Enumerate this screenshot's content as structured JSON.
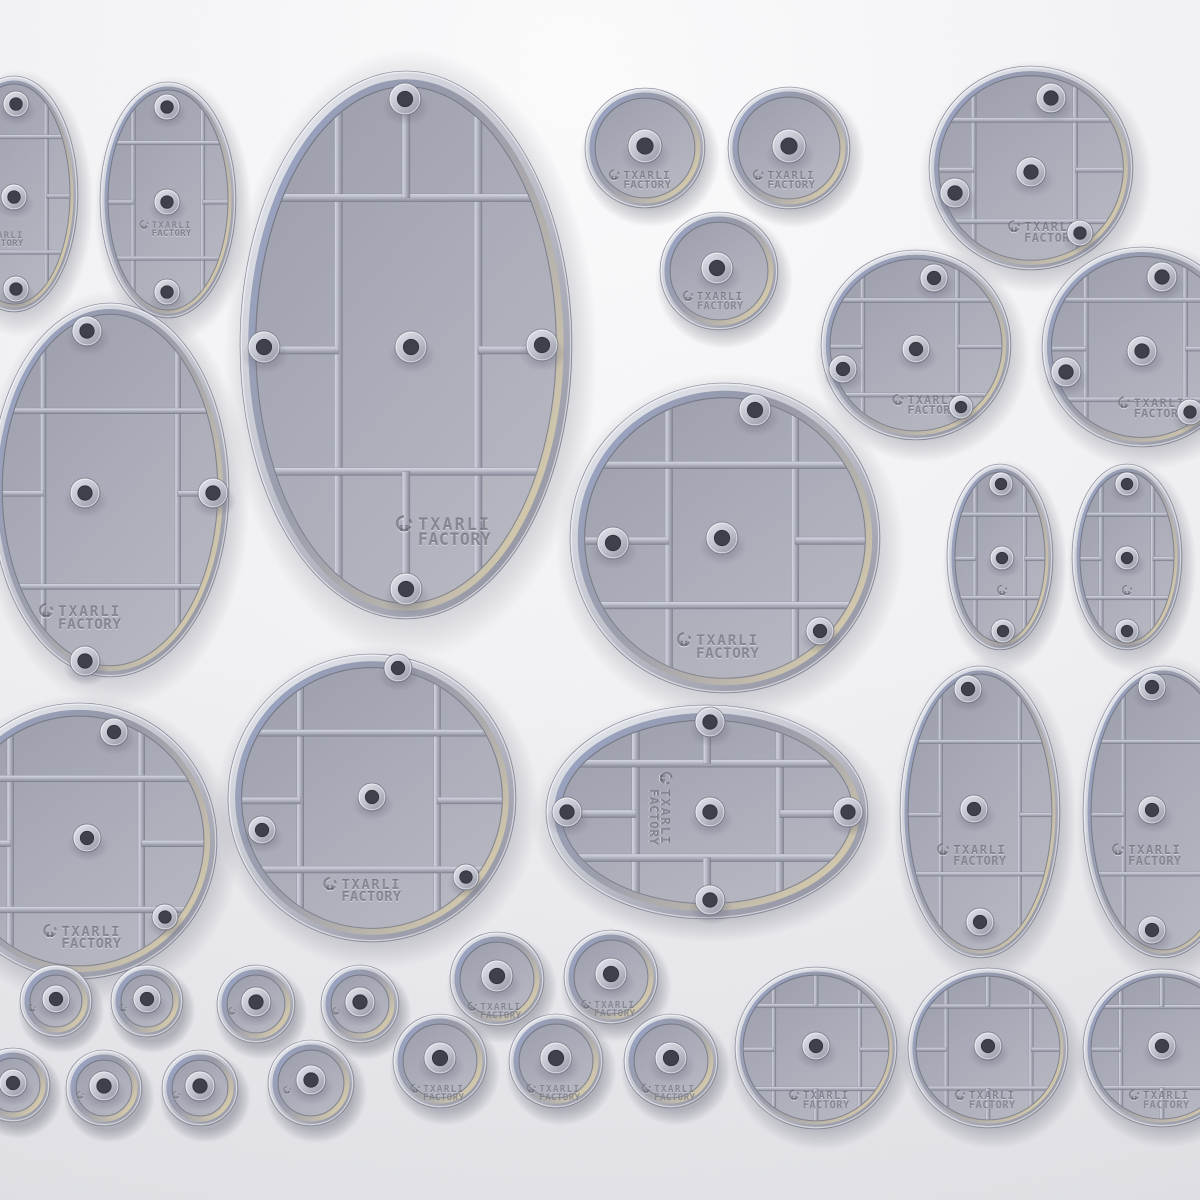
{
  "image": {
    "kind": "3d-product-render",
    "subject": "hollow miniature bases sprue-less set, top-down render"
  },
  "brand": {
    "logo_line1": "TXARLI",
    "logo_line2": "FACTORY",
    "logo_icon": "helmet-icon"
  },
  "palette": {
    "background_top": "#fbfbfc",
    "background_edge": "#e7e7eb",
    "rim_light": "#eceef4",
    "rim_dark": "#8f919f",
    "recess_dark": "#868898",
    "recess_tan": "#c8c1ad",
    "floor_gray": "#aeb0bc",
    "rib_highlight": "#d9dce8",
    "rib_shadow": "#878998",
    "accent_blue": "#9fb0dc",
    "accent_tan": "#d6cbac",
    "peg_hole": "#3e3f49",
    "engraving": "#595b68"
  },
  "bases": [
    {
      "id": "oval-cut-top-left",
      "shape": "ellipse",
      "style": "ribbed",
      "cx": 14,
      "cy": 194,
      "rx": 64,
      "ry": 118,
      "vx": [
        -0.58,
        0.58
      ],
      "hy": [
        -0.52,
        0.53
      ],
      "stubs": [
        "l",
        "r"
      ],
      "pegs": [
        [
          16,
          104,
          13
        ],
        [
          14,
          197,
          13
        ],
        [
          16,
          289,
          13
        ]
      ],
      "logo": {
        "x": 0,
        "y": 238,
        "s": 0.6
      }
    },
    {
      "id": "oval-top-left",
      "shape": "ellipse",
      "style": "ribbed",
      "cx": 168,
      "cy": 200,
      "rx": 68,
      "ry": 118,
      "vx": [
        -0.58,
        0.58
      ],
      "hy": [
        -0.52,
        0.53
      ],
      "stubs": [
        "l",
        "r"
      ],
      "pegs": [
        [
          167,
          107,
          13
        ],
        [
          167,
          202,
          13
        ],
        [
          167,
          292,
          13
        ]
      ],
      "logo": {
        "x": 168,
        "y": 228,
        "s": 0.6
      }
    },
    {
      "id": "oval-large-top",
      "shape": "ellipse",
      "style": "ribbed",
      "cx": 406,
      "cy": 345,
      "rx": 166,
      "ry": 274,
      "vx": [
        -0.45,
        0.48
      ],
      "hy": [
        -0.57,
        0.49
      ],
      "stubs": [
        "t",
        "b",
        "l",
        "r"
      ],
      "pegs": [
        [
          405,
          99,
          16
        ],
        [
          264,
          347,
          16
        ],
        [
          542,
          345,
          16
        ],
        [
          411,
          347,
          16
        ],
        [
          406,
          589,
          16
        ]
      ],
      "logo": {
        "x": 448,
        "y": 530,
        "s": 1.1
      }
    },
    {
      "id": "circle-plain-top-1",
      "shape": "circle",
      "style": "plain",
      "cx": 645,
      "cy": 148,
      "r": 60,
      "pegs": [
        [
          645,
          146,
          17
        ]
      ],
      "logo": {
        "x": 643,
        "y": 179,
        "s": 0.72
      }
    },
    {
      "id": "circle-plain-top-2",
      "shape": "circle",
      "style": "plain",
      "cx": 789,
      "cy": 148,
      "r": 61,
      "pegs": [
        [
          789,
          146,
          17
        ]
      ],
      "logo": {
        "x": 787,
        "y": 179,
        "s": 0.72
      }
    },
    {
      "id": "circle-plain-top-3",
      "shape": "circle",
      "style": "plain",
      "cx": 719,
      "cy": 271,
      "r": 59,
      "pegs": [
        [
          717,
          268,
          16
        ]
      ],
      "logo": {
        "x": 716,
        "y": 300,
        "s": 0.7
      }
    },
    {
      "id": "circle-ribbed-tr-1",
      "shape": "circle",
      "style": "ribbed",
      "cx": 1031,
      "cy": 168,
      "r": 102,
      "vx": [
        -0.62,
        0.48
      ],
      "hy": [
        -0.52,
        0.58
      ],
      "stubs": [
        "l",
        "r"
      ],
      "pegs": [
        [
          1051,
          98,
          15
        ],
        [
          955,
          193,
          15
        ],
        [
          1031,
          172,
          15
        ],
        [
          1080,
          233,
          13
        ]
      ],
      "logo": {
        "x": 1046,
        "y": 231,
        "s": 0.8
      }
    },
    {
      "id": "circle-ribbed-tr-2",
      "shape": "circle",
      "style": "ribbed",
      "cx": 916,
      "cy": 345,
      "r": 95,
      "vx": [
        -0.62,
        0.48
      ],
      "hy": [
        -0.52,
        0.58
      ],
      "stubs": [
        "l",
        "r"
      ],
      "pegs": [
        [
          934,
          278,
          14
        ],
        [
          843,
          369,
          14
        ],
        [
          916,
          349,
          14
        ],
        [
          961,
          407,
          12
        ]
      ],
      "logo": {
        "x": 928,
        "y": 404,
        "s": 0.75
      }
    },
    {
      "id": "circle-ribbed-tr-3",
      "shape": "circle",
      "style": "ribbed",
      "cx": 1142,
      "cy": 347,
      "r": 100,
      "vx": [
        -0.62,
        0.48
      ],
      "hy": [
        -0.52,
        0.58
      ],
      "stubs": [
        "l",
        "r"
      ],
      "pegs": [
        [
          1162,
          277,
          15
        ],
        [
          1066,
          372,
          15
        ],
        [
          1142,
          351,
          15
        ],
        [
          1190,
          412,
          13
        ]
      ],
      "logo": {
        "x": 1155,
        "y": 407,
        "s": 0.78
      }
    },
    {
      "id": "oval-cut-mid-left",
      "shape": "ellipse",
      "style": "ribbed",
      "cx": 110,
      "cy": 490,
      "rx": 119,
      "ry": 187,
      "vx": [
        -0.62,
        0.63
      ],
      "hy": [
        -0.45,
        0.55
      ],
      "stubs": [
        "l",
        "r"
      ],
      "pegs": [
        [
          87,
          331,
          15
        ],
        [
          85,
          493,
          15
        ],
        [
          213,
          493,
          15
        ],
        [
          85,
          661,
          15
        ]
      ],
      "logo": {
        "x": 84,
        "y": 616,
        "s": 0.95
      }
    },
    {
      "id": "circle-ribbed-center",
      "shape": "circle",
      "style": "ribbed",
      "cx": 725,
      "cy": 538,
      "r": 155,
      "vx": [
        -0.4,
        0.5
      ],
      "hy": [
        -0.52,
        0.48
      ],
      "stubs": [
        "l",
        "r"
      ],
      "pegs": [
        [
          755,
          410,
          16
        ],
        [
          613,
          543,
          16
        ],
        [
          722,
          538,
          16
        ],
        [
          820,
          631,
          14
        ]
      ],
      "logo": {
        "x": 722,
        "y": 645,
        "s": 0.95
      }
    },
    {
      "id": "oval-small-right-1",
      "shape": "ellipse",
      "style": "ribbed",
      "cx": 1000,
      "cy": 557,
      "rx": 53,
      "ry": 93,
      "vx": [
        -0.55,
        0.55
      ],
      "hy": [
        -0.5,
        0.48
      ],
      "stubs": [
        "l",
        "r"
      ],
      "pegs": [
        [
          1001,
          484,
          12
        ],
        [
          1002,
          558,
          12
        ],
        [
          1003,
          631,
          12
        ]
      ],
      "logo": {
        "x": 1002,
        "y": 590,
        "s": 0.7,
        "icon_only": true
      }
    },
    {
      "id": "oval-small-right-2",
      "shape": "ellipse",
      "style": "ribbed",
      "cx": 1127,
      "cy": 557,
      "rx": 55,
      "ry": 93,
      "vx": [
        -0.55,
        0.55
      ],
      "hy": [
        -0.5,
        0.48
      ],
      "stubs": [
        "l",
        "r"
      ],
      "pegs": [
        [
          1127,
          484,
          12
        ],
        [
          1127,
          558,
          12
        ],
        [
          1127,
          631,
          12
        ]
      ],
      "logo": {
        "x": 1127,
        "y": 590,
        "s": 0.7,
        "icon_only": true
      }
    },
    {
      "id": "circle-ribbed-cut-bottom-left",
      "shape": "circle",
      "style": "ribbed",
      "cx": 79,
      "cy": 841,
      "r": 138,
      "vx": [
        -0.55,
        0.5
      ],
      "hy": [
        -0.5,
        0.55
      ],
      "stubs": [
        "l",
        "r"
      ],
      "pegs": [
        [
          114,
          732,
          14
        ],
        [
          87,
          838,
          14
        ],
        [
          165,
          917,
          13
        ]
      ],
      "logo": {
        "x": 86,
        "y": 936,
        "s": 0.9
      }
    },
    {
      "id": "circle-ribbed-bottom-mid",
      "shape": "circle",
      "style": "ribbed",
      "cx": 372,
      "cy": 798,
      "r": 144,
      "vx": [
        -0.55,
        0.5
      ],
      "hy": [
        -0.5,
        0.55
      ],
      "stubs": [
        "l",
        "r"
      ],
      "pegs": [
        [
          398,
          668,
          14
        ],
        [
          262,
          830,
          14
        ],
        [
          372,
          797,
          14
        ],
        [
          466,
          877,
          13
        ]
      ],
      "logo": {
        "x": 366,
        "y": 889,
        "s": 0.9
      }
    },
    {
      "id": "oval-egg-horizontal",
      "shape": "ellipse",
      "style": "ribbed",
      "cx": 707,
      "cy": 812,
      "rx": 161,
      "ry": 107,
      "vx": [
        -0.49,
        0.5
      ],
      "hy": [
        -0.53,
        0.5
      ],
      "stubs": [
        "t",
        "b",
        "l",
        "r"
      ],
      "pegs": [
        [
          710,
          722,
          15
        ],
        [
          567,
          812,
          15
        ],
        [
          710,
          812,
          15
        ],
        [
          848,
          812,
          15
        ],
        [
          710,
          900,
          15
        ]
      ],
      "logo": {
        "x": 661,
        "y": 812,
        "s": 0.85,
        "rot": 90
      }
    },
    {
      "id": "oval-mid-right-1",
      "shape": "ellipse",
      "style": "ribbed",
      "cx": 980,
      "cy": 812,
      "rx": 80,
      "ry": 146,
      "vx": [
        -0.55,
        0.55
      ],
      "hy": [
        -0.51,
        0.45
      ],
      "stubs": [
        "l",
        "r"
      ],
      "pegs": [
        [
          968,
          689,
          14
        ],
        [
          974,
          809,
          14
        ],
        [
          980,
          922,
          14
        ]
      ],
      "logo": {
        "x": 975,
        "y": 854,
        "s": 0.8
      }
    },
    {
      "id": "oval-cut-mid-right-2",
      "shape": "ellipse",
      "style": "ribbed",
      "cx": 1163,
      "cy": 812,
      "rx": 80,
      "ry": 146,
      "vx": [
        -0.55,
        0.55
      ],
      "hy": [
        -0.51,
        0.45
      ],
      "stubs": [
        "l",
        "r"
      ],
      "pegs": [
        [
          1152,
          687,
          14
        ],
        [
          1152,
          810,
          14
        ],
        [
          1152,
          930,
          14
        ]
      ],
      "logo": {
        "x": 1150,
        "y": 854,
        "s": 0.8
      }
    },
    {
      "id": "circle-small-a1",
      "shape": "circle",
      "style": "plain",
      "cx": 56,
      "cy": 1001,
      "r": 36,
      "pegs": [
        [
          56,
          999,
          14
        ]
      ],
      "logo": {
        "x": 32,
        "y": 1008,
        "s": 0.5,
        "icon_only": true
      }
    },
    {
      "id": "circle-small-a2",
      "shape": "circle",
      "style": "plain",
      "cx": 147,
      "cy": 1001,
      "r": 36,
      "pegs": [
        [
          147,
          999,
          14
        ]
      ],
      "logo": {
        "x": 123,
        "y": 1008,
        "s": 0.5,
        "icon_only": true
      }
    },
    {
      "id": "circle-small-a3",
      "shape": "circle",
      "style": "plain",
      "cx": 256,
      "cy": 1004,
      "r": 39,
      "pegs": [
        [
          256,
          1002,
          15
        ]
      ],
      "logo": {
        "x": 232,
        "y": 1011,
        "s": 0.5,
        "icon_only": true
      }
    },
    {
      "id": "circle-small-a4",
      "shape": "circle",
      "style": "plain",
      "cx": 360,
      "cy": 1004,
      "r": 39,
      "pegs": [
        [
          360,
          1002,
          15
        ]
      ],
      "logo": {
        "x": 336,
        "y": 1011,
        "s": 0.5,
        "icon_only": true
      }
    },
    {
      "id": "circle-medium-a5",
      "shape": "circle",
      "style": "plain",
      "cx": 497,
      "cy": 979,
      "r": 47,
      "pegs": [
        [
          497,
          976,
          16
        ]
      ],
      "logo": {
        "x": 497,
        "y": 1010,
        "s": 0.62
      }
    },
    {
      "id": "circle-medium-a6",
      "shape": "circle",
      "style": "plain",
      "cx": 611,
      "cy": 977,
      "r": 47,
      "pegs": [
        [
          611,
          974,
          16
        ]
      ],
      "logo": {
        "x": 611,
        "y": 1008,
        "s": 0.62
      }
    },
    {
      "id": "circle-small-b1-cut",
      "shape": "circle",
      "style": "plain",
      "cx": 13,
      "cy": 1085,
      "r": 37,
      "pegs": [
        [
          13,
          1083,
          14
        ]
      ],
      "logo": {
        "x": -11,
        "y": 1092,
        "s": 0.5,
        "icon_only": true
      }
    },
    {
      "id": "circle-small-b2",
      "shape": "circle",
      "style": "plain",
      "cx": 104,
      "cy": 1088,
      "r": 38,
      "pegs": [
        [
          104,
          1086,
          15
        ]
      ],
      "logo": {
        "x": 80,
        "y": 1095,
        "s": 0.5,
        "icon_only": true
      }
    },
    {
      "id": "circle-small-b3",
      "shape": "circle",
      "style": "plain",
      "cx": 200,
      "cy": 1088,
      "r": 38,
      "pegs": [
        [
          200,
          1086,
          15
        ]
      ],
      "logo": {
        "x": 176,
        "y": 1095,
        "s": 0.5,
        "icon_only": true
      }
    },
    {
      "id": "circle-small-b4",
      "shape": "circle",
      "style": "plain",
      "cx": 311,
      "cy": 1083,
      "r": 43,
      "pegs": [
        [
          311,
          1080,
          15
        ]
      ],
      "logo": {
        "x": 287,
        "y": 1090,
        "s": 0.5,
        "icon_only": true
      }
    },
    {
      "id": "circle-medium-b5",
      "shape": "circle",
      "style": "plain",
      "cx": 440,
      "cy": 1061,
      "r": 47,
      "pegs": [
        [
          440,
          1058,
          16
        ]
      ],
      "logo": {
        "x": 440,
        "y": 1092,
        "s": 0.62
      }
    },
    {
      "id": "circle-medium-b6",
      "shape": "circle",
      "style": "plain",
      "cx": 556,
      "cy": 1061,
      "r": 47,
      "pegs": [
        [
          556,
          1058,
          16
        ]
      ],
      "logo": {
        "x": 556,
        "y": 1092,
        "s": 0.62
      }
    },
    {
      "id": "circle-medium-b7",
      "shape": "circle",
      "style": "plain",
      "cx": 671,
      "cy": 1061,
      "r": 47,
      "pegs": [
        [
          671,
          1058,
          16
        ]
      ],
      "logo": {
        "x": 671,
        "y": 1092,
        "s": 0.62
      }
    },
    {
      "id": "circle-ribbed-bottom-1",
      "shape": "circle",
      "style": "ribbed",
      "cx": 816,
      "cy": 1048,
      "r": 81,
      "vx": [
        -0.58,
        0.6
      ],
      "hy": [
        -0.58,
        0.56
      ],
      "stubs": [
        "t",
        "b",
        "l",
        "r"
      ],
      "pegs": [
        [
          816,
          1046,
          14
        ]
      ],
      "logo": {
        "x": 822,
        "y": 1099,
        "s": 0.7
      }
    },
    {
      "id": "circle-ribbed-bottom-2",
      "shape": "circle",
      "style": "ribbed",
      "cx": 988,
      "cy": 1048,
      "r": 80,
      "vx": [
        -0.58,
        0.6
      ],
      "hy": [
        -0.58,
        0.56
      ],
      "stubs": [
        "t",
        "b",
        "l",
        "r"
      ],
      "pegs": [
        [
          988,
          1046,
          14
        ]
      ],
      "logo": {
        "x": 988,
        "y": 1099,
        "s": 0.7
      }
    },
    {
      "id": "circle-ribbed-cut-bottom-3",
      "shape": "circle",
      "style": "ribbed",
      "cx": 1162,
      "cy": 1048,
      "r": 79,
      "vx": [
        -0.58,
        0.6
      ],
      "hy": [
        -0.58,
        0.56
      ],
      "stubs": [
        "t",
        "b",
        "l",
        "r"
      ],
      "pegs": [
        [
          1162,
          1046,
          14
        ]
      ],
      "logo": {
        "x": 1162,
        "y": 1099,
        "s": 0.7
      }
    }
  ]
}
